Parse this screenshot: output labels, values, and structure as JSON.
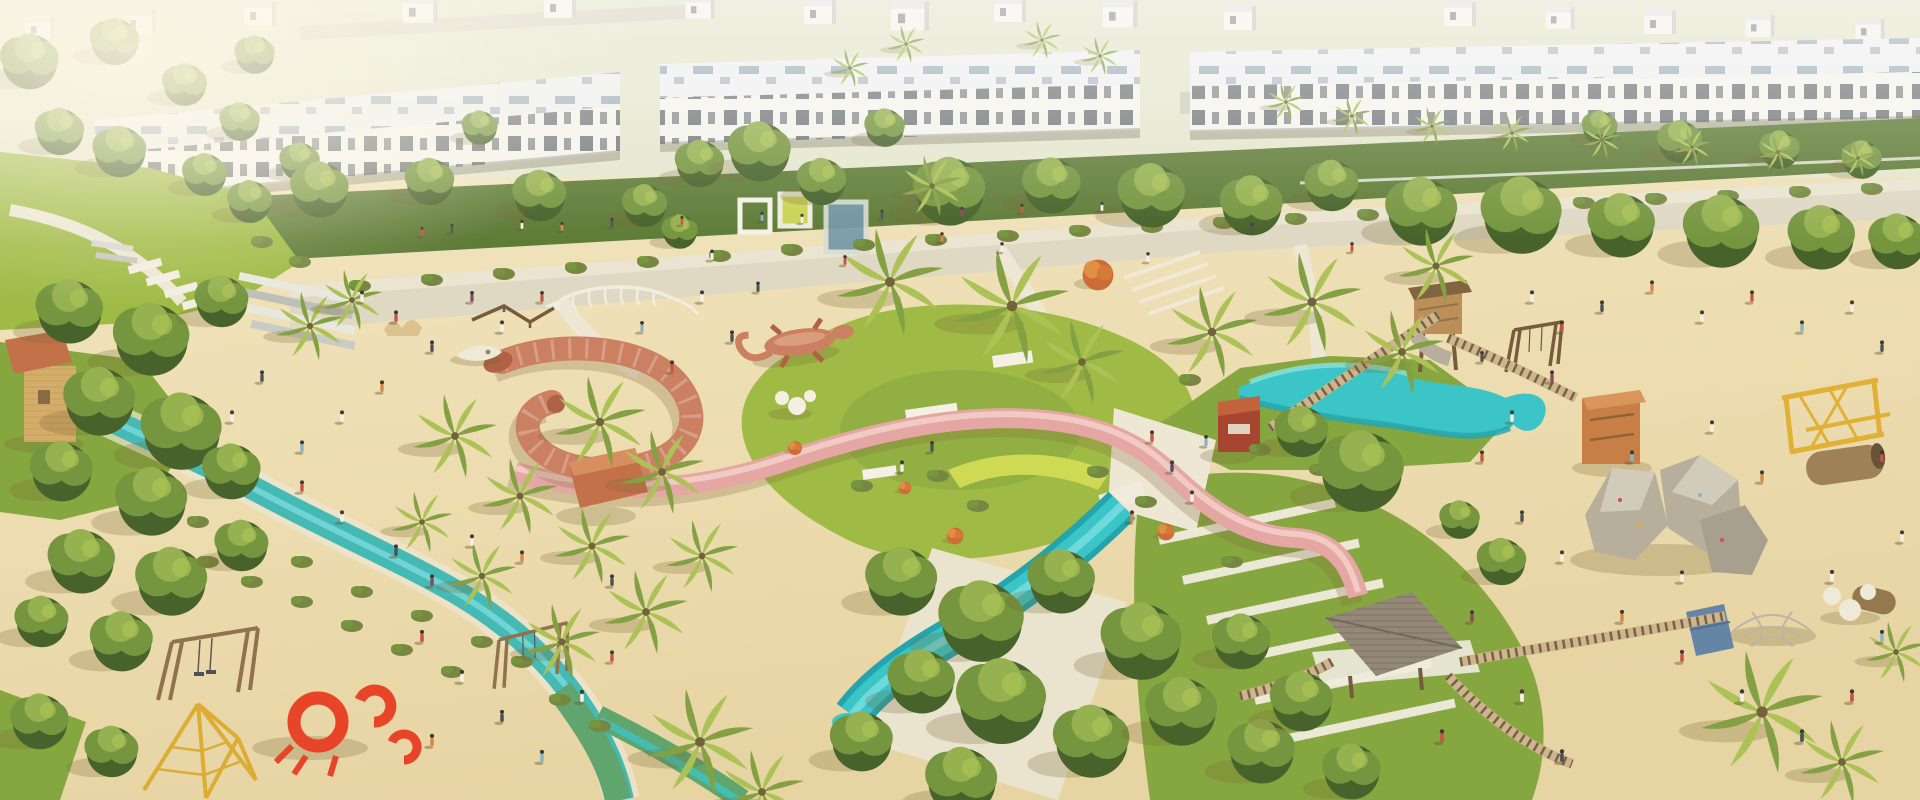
{
  "scene": {
    "setting": "aerial-render-community-playground-park",
    "objects": [
      "townhouse-row",
      "far-house-row",
      "street",
      "white-car",
      "promenade",
      "pergola-frames",
      "left-lawn",
      "stepping-pads",
      "stepped-benches",
      "tan-play-tower",
      "lazy-river",
      "green-play-track",
      "palm-trees",
      "shade-trees",
      "flowering-trees",
      "shrubs",
      "sand-playfield",
      "serpent-sculpture",
      "dinosaur-skeleton-sculpture",
      "whale-skull-sculpture",
      "bone-sculpture",
      "balance-beams",
      "gecko-sculpture",
      "sphere-seats",
      "shade-pavilion",
      "pink-ribbon-slide",
      "teal-slide-upper",
      "teal-slide-lower",
      "net-hammock",
      "central-plaza",
      "seating-terraces",
      "amphitheater-steps",
      "play-kiosk",
      "wood-play-tower",
      "orange-play-tower",
      "climbing-boulders",
      "tree-house",
      "rope-bridges",
      "swing-sets",
      "rope-course",
      "climbing-pyramid",
      "crab-sculpture",
      "log-tunnels",
      "dome-climber",
      "climbing-wedge",
      "people"
    ]
  },
  "colors": {
    "sand": "#ecdcae",
    "sandLight": "#f7edcc",
    "sandShadow": "#d9c492",
    "grass": "#9ab83f",
    "grassMid": "#7fa338",
    "grassDark": "#5d7f2e",
    "treeLight": "#8fae4a",
    "treeMid": "#6d9038",
    "treeDark": "#4e7029",
    "treeDeep": "#3c5a22",
    "palmLight": "#a7c050",
    "palmDark": "#7c9c3c",
    "olive": "#6f813a",
    "teal": "#2fc3c8",
    "tealDeep": "#17a0ac",
    "tealLight": "#7fe3e6",
    "riverTeal": "#3ab6b4",
    "track": "#57a06a",
    "pink": "#e4a3a2",
    "pinkLight": "#f2c8c5",
    "coral": "#c97a5d",
    "coralDark": "#ab5a3e",
    "red": "#e63a1f",
    "yellow": "#dfae2e",
    "lime": "#cdd94e",
    "wood": "#b98a52",
    "woodDark": "#6e5336",
    "woodOrange": "#c4793f",
    "kiosk": "#a23b28",
    "terracotta": "#c06a41",
    "rock": "#b3ac9b",
    "rockLight": "#cfc9ba",
    "roof": "#eef1f4",
    "roofVent": "#93a7b8",
    "wall": "#f4f4f0",
    "wallShade": "#d8d8d2",
    "window": "#4d545c",
    "path": "#ddd7c4",
    "pathLight": "#ece7d6",
    "concrete": "#cfc9b8",
    "bone": "#f2eee0",
    "shadow": "rgba(110,90,45,0.25)",
    "people_palette": [
      "#c84b3a",
      "#f5f2ea",
      "#3f4a52",
      "#d9813f",
      "#7fb2c9",
      "#8a3b5e",
      "#2f6e66",
      "#caa05f"
    ]
  }
}
